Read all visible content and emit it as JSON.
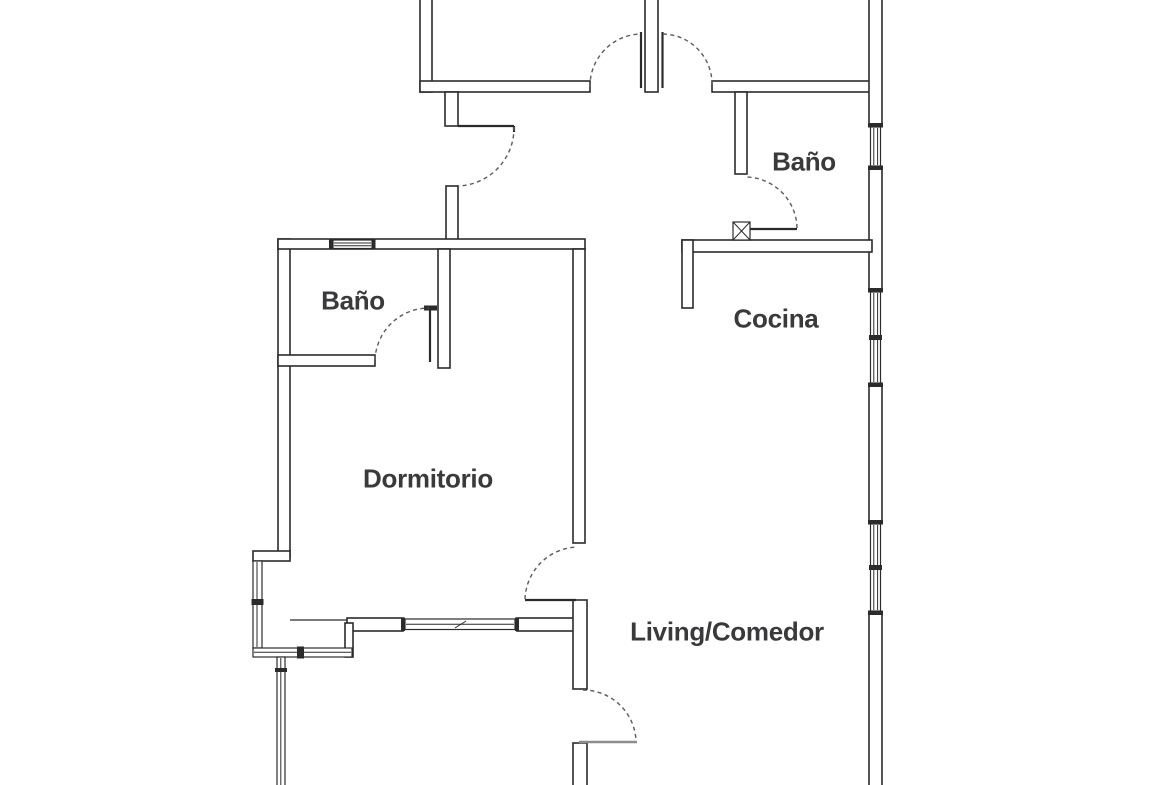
{
  "plan": {
    "type": "apartment-floor-plan",
    "visible_room_count": 5
  },
  "rooms": [
    {
      "id": "bano-left",
      "label": "Baño"
    },
    {
      "id": "dormitorio",
      "label": "Dormitorio"
    },
    {
      "id": "bano-right",
      "label": "Baño"
    },
    {
      "id": "cocina",
      "label": "Cocina"
    },
    {
      "id": "living-comedor",
      "label": "Living/Comedor"
    }
  ],
  "colors": {
    "background": "#ffffff",
    "wall": "#2b2b2b",
    "label": "#3a3a3c",
    "door_arc": "#5a5a5a",
    "door_leaf_light": "#8d8d8d"
  }
}
